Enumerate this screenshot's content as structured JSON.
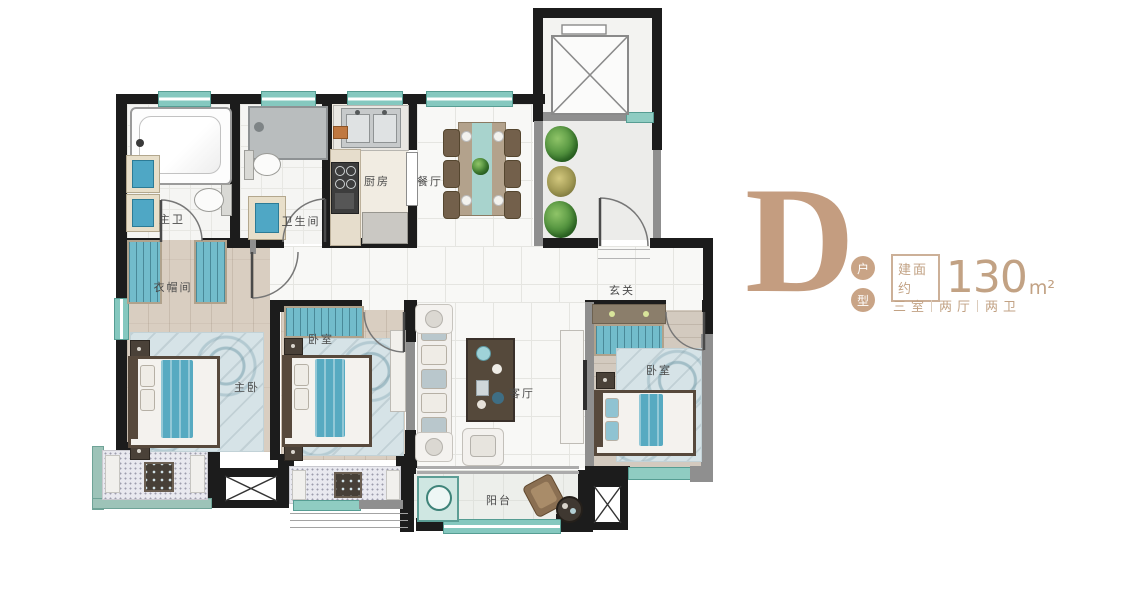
{
  "page": {
    "background": "#ffffff",
    "type": "residential floor plan"
  },
  "rooms": [
    {
      "name": "master-bathroom",
      "label": "主卫"
    },
    {
      "name": "bathroom",
      "label": "卫生间"
    },
    {
      "name": "kitchen",
      "label": "厨房"
    },
    {
      "name": "dining-room",
      "label": "餐厅"
    },
    {
      "name": "foyer",
      "label": "玄关"
    },
    {
      "name": "cloakroom",
      "label": "衣帽间"
    },
    {
      "name": "master-bedroom",
      "label": "主卧"
    },
    {
      "name": "bedroom-middle",
      "label": "卧室"
    },
    {
      "name": "living-room",
      "label": "客厅"
    },
    {
      "name": "bedroom-east",
      "label": "卧室"
    },
    {
      "name": "balcony",
      "label": "阳台"
    }
  ],
  "info_panel": {
    "plan_letter": "D",
    "unit_type_chars": [
      "户",
      "型"
    ],
    "area_prefix": "建面约",
    "area_value": "130",
    "area_unit": "m²",
    "specs": [
      "三室",
      "两厅",
      "两卫"
    ]
  },
  "colors": {
    "wall": "#1c1c1c",
    "window_teal": "#85c8bf",
    "furniture_teal": "#57aac1",
    "wood_floor": "#d9cec1",
    "accent_tan": "#c49d80"
  }
}
